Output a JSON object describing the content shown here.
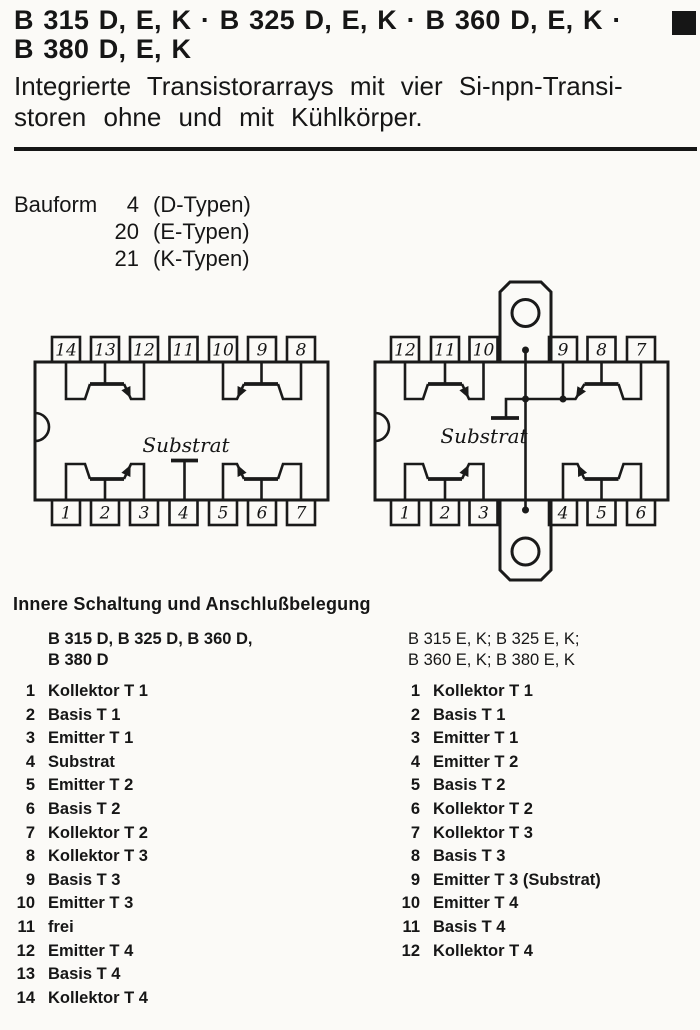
{
  "header": {
    "title_line1": "B 315 D, E, K · B 325 D, E, K · B 360 D, E, K ·",
    "title_line2": "B 380 D, E, K",
    "corner_marker": "filled-black-square"
  },
  "subtitle": {
    "line1": "Integrierte Transistorarrays mit vier Si-npn-Transi-",
    "line2": "storen ohne und mit Kühlkörper."
  },
  "bauform": {
    "label": "Bauform",
    "rows": [
      {
        "num": "4",
        "type": "(D-Typen)"
      },
      {
        "num": "20",
        "type": "(E-Typen)"
      },
      {
        "num": "21",
        "type": "(K-Typen)"
      }
    ]
  },
  "diagrams": {
    "left": {
      "substrate_label": "Substrat",
      "top_pins": [
        "14",
        "13",
        "12",
        "11",
        "10",
        "9",
        "8"
      ],
      "bottom_pins": [
        "1",
        "2",
        "3",
        "4",
        "5",
        "6",
        "7"
      ]
    },
    "right": {
      "substrate_label": "Substrat",
      "top_pins": [
        "12",
        "11",
        "10",
        "9",
        "8",
        "7"
      ],
      "bottom_pins": [
        "1",
        "2",
        "3",
        "4",
        "5",
        "6"
      ]
    }
  },
  "pinout": {
    "heading": "Innere Schaltung und Anschlußbelegung",
    "left": {
      "header_line1": "B 315 D, B 325 D, B 360 D,",
      "header_line2": "B 380 D",
      "pins": [
        {
          "num": "1",
          "label": "Kollektor T 1"
        },
        {
          "num": "2",
          "label": "Basis T 1"
        },
        {
          "num": "3",
          "label": "Emitter T 1"
        },
        {
          "num": "4",
          "label": "Substrat"
        },
        {
          "num": "5",
          "label": "Emitter T 2"
        },
        {
          "num": "6",
          "label": "Basis T 2"
        },
        {
          "num": "7",
          "label": "Kollektor T 2"
        },
        {
          "num": "8",
          "label": "Kollektor T 3"
        },
        {
          "num": "9",
          "label": "Basis T 3"
        },
        {
          "num": "10",
          "label": "Emitter T 3"
        },
        {
          "num": "11",
          "label": "frei"
        },
        {
          "num": "12",
          "label": "Emitter T 4"
        },
        {
          "num": "13",
          "label": "Basis T 4"
        },
        {
          "num": "14",
          "label": "Kollektor T 4"
        }
      ]
    },
    "right": {
      "header_line1": "B 315 E, K; B 325 E, K;",
      "header_line2": "B 360 E, K; B 380 E, K",
      "pins": [
        {
          "num": "1",
          "label": "Kollektor T 1"
        },
        {
          "num": "2",
          "label": "Basis T 1"
        },
        {
          "num": "3",
          "label": "Emitter T 1"
        },
        {
          "num": "4",
          "label": "Emitter T 2"
        },
        {
          "num": "5",
          "label": "Basis T 2"
        },
        {
          "num": "6",
          "label": "Kollektor T 2"
        },
        {
          "num": "7",
          "label": "Kollektor T 3"
        },
        {
          "num": "8",
          "label": "Basis T 3"
        },
        {
          "num": "9",
          "label": "Emitter T 3 (Substrat)"
        },
        {
          "num": "10",
          "label": "Emitter T 4"
        },
        {
          "num": "11",
          "label": "Basis T 4"
        },
        {
          "num": "12",
          "label": "Kollektor T 4"
        }
      ]
    }
  },
  "colors": {
    "ink": "#161616",
    "paper": "#fbfaf7"
  }
}
